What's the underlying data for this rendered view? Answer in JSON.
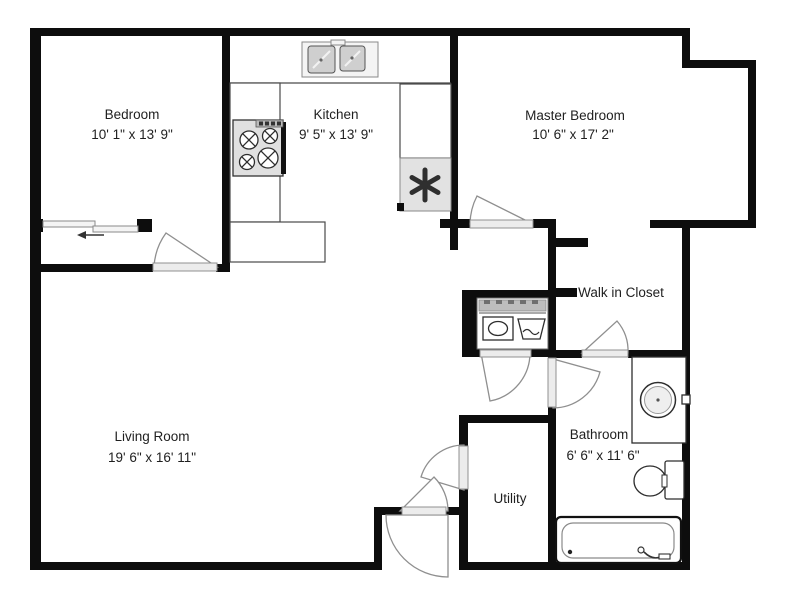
{
  "floor_plan": {
    "rooms": {
      "bedroom": {
        "name": "Bedroom",
        "dimensions": "10' 1\" x 13' 9\""
      },
      "kitchen": {
        "name": "Kitchen",
        "dimensions": "9' 5\" x 13' 9\""
      },
      "master_bedroom": {
        "name": "Master Bedroom",
        "dimensions": "10' 6\" x 17' 2\""
      },
      "walk_in_closet": {
        "name": "Walk in Closet"
      },
      "living_room": {
        "name": "Living Room",
        "dimensions": "19' 6\" x 16' 11\""
      },
      "utility": {
        "name": "Utility"
      },
      "bathroom": {
        "name": "Bathroom",
        "dimensions": "6' 6\" x 11' 6\""
      }
    },
    "icons": {
      "water_heater_symbol": "✱",
      "fixtures": [
        "kitchen-sink",
        "stove",
        "water-heater",
        "washer",
        "dryer",
        "vanity-sink",
        "toilet",
        "bathtub",
        "sliding-closet-doors"
      ]
    },
    "colors": {
      "wall": "#0d0d0d",
      "background": "#ffffff",
      "fixture_outline": "#4a4a4a",
      "door_swing": "#8f8f8f",
      "shading": "#e2e2e2"
    }
  }
}
